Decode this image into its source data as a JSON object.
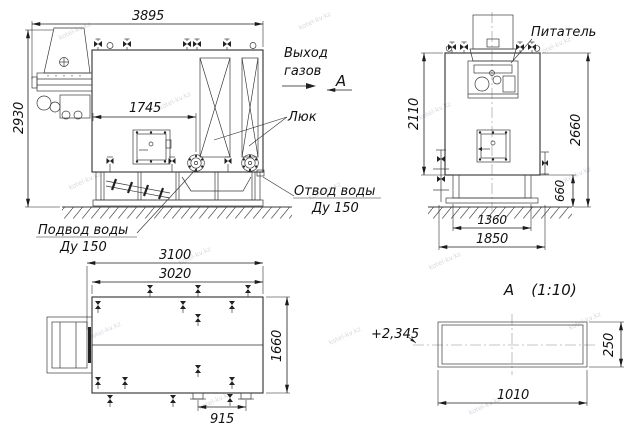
{
  "labels": {
    "gas_outlet_line1": "Выход",
    "gas_outlet_line2": "газов",
    "view_arrow_letter": "А",
    "hatch": "Люк",
    "feeder": "Питатель",
    "water_outlet_line1": "Отвод воды",
    "water_outlet_line2": "Ду 150",
    "water_inlet_line1": "Подвод воды",
    "water_inlet_line2": "Ду 150",
    "section_letter": "А",
    "section_scale": "(1:10)",
    "elevation_mark": "+2,345"
  },
  "dimensions": {
    "side_view": {
      "overall_length": "3895",
      "overall_height": "2930",
      "door_offset": "1745"
    },
    "front_view": {
      "body_height": "2110",
      "total_height": "2660",
      "base_height": "660",
      "base_width": "1360",
      "base_overall_width": "1850"
    },
    "top_view": {
      "overall_length": "3100",
      "body_length": "3020",
      "body_width": "1660",
      "stub_spacing": "915"
    },
    "section_a": {
      "duct_height": "250",
      "duct_width": "1010"
    }
  },
  "watermark": {
    "text": "kotel-kv.kz"
  },
  "colors": {
    "line": "#2e2e2e",
    "dimension": "#1c1c1c",
    "background": "#ffffff",
    "watermark": "#b4bac6"
  }
}
